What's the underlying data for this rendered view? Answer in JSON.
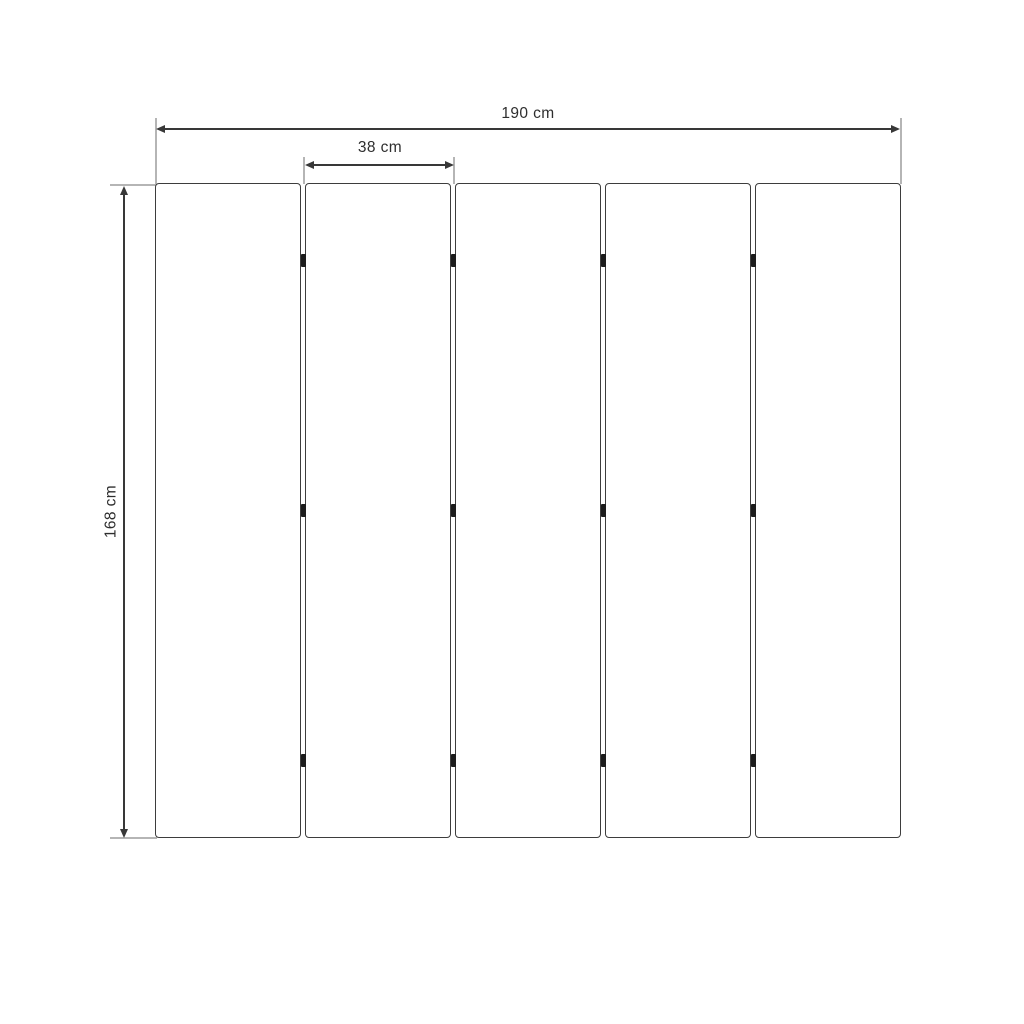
{
  "diagram": {
    "type": "dimension-diagram",
    "description": "Front view of a five-panel folding screen with hinge marks and three measurements",
    "labels": {
      "total_width": "190 cm",
      "panel_width": "38 cm",
      "height": "168 cm"
    },
    "measurements_cm": {
      "total_width": 190,
      "panel_width": 38,
      "height": 168,
      "panel_count": 5,
      "hinges_per_gap": 3
    },
    "colors": {
      "background": "#ffffff",
      "panel_fill": "#ffffff",
      "panel_border": "#3d3d3d",
      "dimension_line": "#383838",
      "extension_line": "#b5b5b5",
      "hinge": "#1c1c1c",
      "text": "#2e2e2e"
    }
  }
}
